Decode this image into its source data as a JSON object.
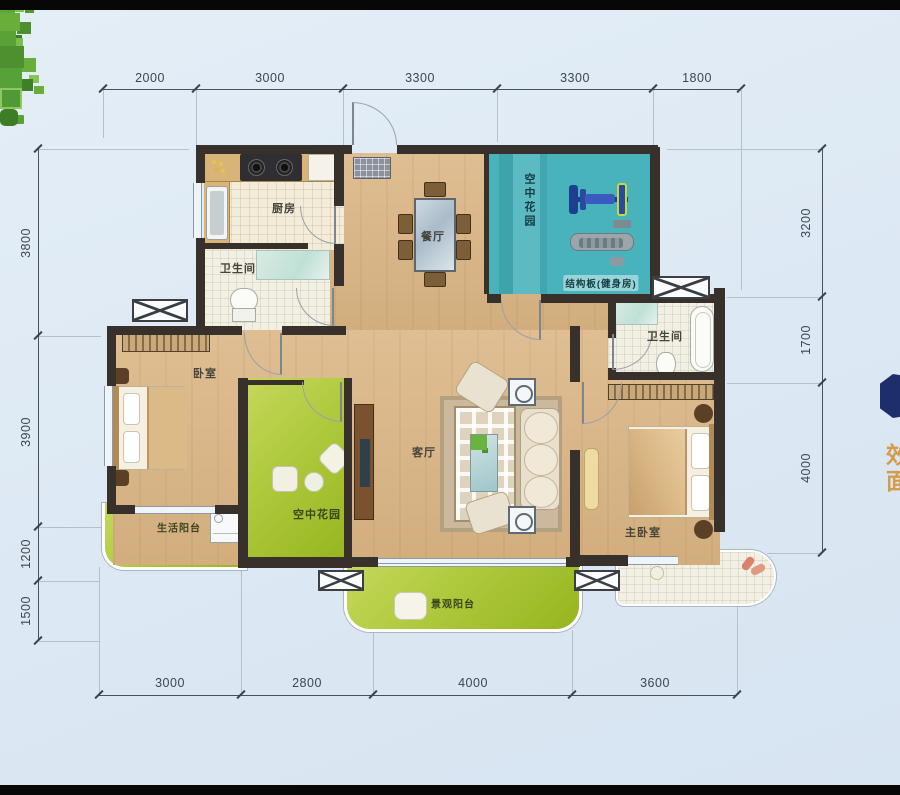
{
  "rooms": {
    "kitchen": "厨房",
    "bath1": "卫生间",
    "dining": "餐厅",
    "sky_garden": "空中花园",
    "gym_note": "结构板(健身房)",
    "bedroom": "卧室",
    "courtyard": "空中花园",
    "living": "客厅",
    "life_balcony": "生活阳台",
    "bath2": "卫生间",
    "master_bedroom": "主卧室",
    "view_balcony": "景观阳台"
  },
  "dims": {
    "top": [
      "2000",
      "3000",
      "3300",
      "3300",
      "1800"
    ],
    "bottom": [
      "3000",
      "2800",
      "4000",
      "3600"
    ],
    "left": [
      "3800",
      "3900",
      "1200",
      "1500"
    ],
    "right": [
      "3200",
      "1700",
      "4000"
    ]
  },
  "edge_text": [
    "效",
    "面"
  ],
  "colors": {
    "wall": "#37302b",
    "wood_floor": "#d8b488",
    "sky_garden_teal": "#49b3bc",
    "garden_green": "#a9c636",
    "background": "#dfe9f4",
    "dimension_text": "#3f4650",
    "edge_badge_navy": "#1e2d6b",
    "edge_text_orange": "#d49c4a"
  }
}
